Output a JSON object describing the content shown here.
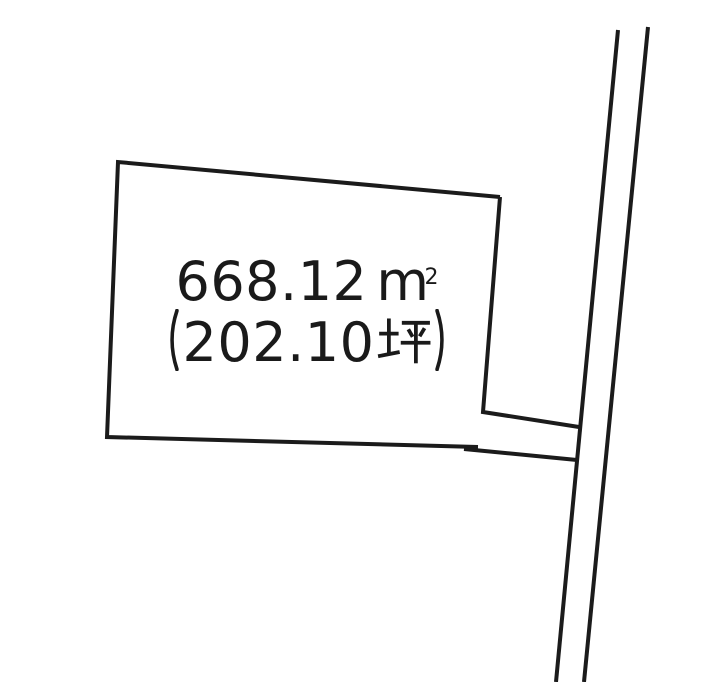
{
  "page": {
    "width": 716,
    "height": 682,
    "background_color": "#ffffff"
  },
  "diagram": {
    "kind": "land-parcel-sketch",
    "line_color": "#1b1b1b",
    "parcel_line_width": 4,
    "road_line_width": 4.5,
    "parcel": {
      "area_sqm_text": "668.12㎡",
      "area_sqm_value": "668.12",
      "area_unit_base": "m",
      "area_unit_exponent": "2",
      "area_tsubo_text": "（202.10坪）",
      "paren_open": "（",
      "area_tsubo_value": "202.10",
      "area_tsubo_unit": "坪",
      "paren_close": "）"
    },
    "geometry": {
      "parcel_main_outline": [
        [
          500,
          197
        ],
        [
          118,
          162
        ],
        [
          107,
          437
        ],
        [
          478,
          447
        ]
      ],
      "parcel_right_edge_and_flag_top": [
        [
          500,
          197
        ],
        [
          483,
          412
        ],
        [
          579,
          427
        ]
      ],
      "flag_strip_bottom": [
        [
          464,
          449
        ],
        [
          577,
          460
        ]
      ],
      "road_edge_left": [
        [
          618,
          30
        ],
        [
          556,
          682
        ]
      ],
      "road_edge_right": [
        [
          648,
          27
        ],
        [
          584,
          682
        ]
      ]
    }
  }
}
